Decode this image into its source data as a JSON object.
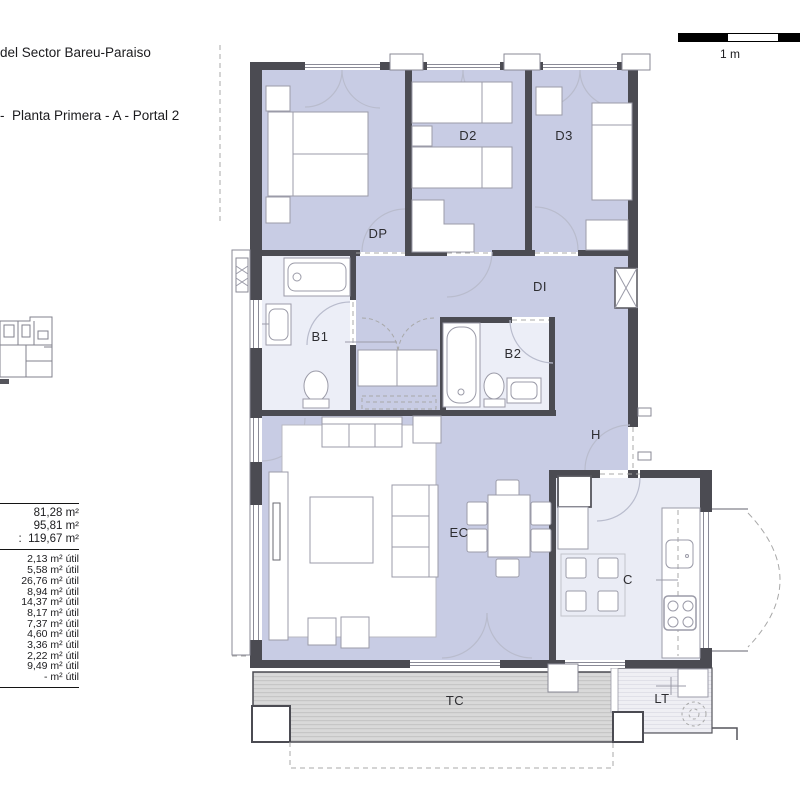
{
  "title": {
    "line1": "del Sector Bareu-Paraiso",
    "line2": "-  Planta Primera - A - Portal 2"
  },
  "scale_bar": {
    "label": "1 m"
  },
  "area_table": {
    "totals": [
      "81,28 m²",
      "95,81 m²",
      ":  119,67 m²"
    ],
    "utiles": [
      "2,13 m² útil",
      "5,58 m² útil",
      "26,76 m² útil",
      "8,94 m² útil",
      "14,37 m² útil",
      "8,17 m² útil",
      "7,37 m² útil",
      "4,60 m² útil",
      "3,36 m² útil",
      "2,22 m² útil",
      "9,49 m² útil",
      "- m² útil"
    ]
  },
  "plan": {
    "labels": {
      "dp": "DP",
      "d2": "D2",
      "d3": "D3",
      "b1": "B1",
      "b2": "B2",
      "di": "DI",
      "h": "H",
      "ec": "EC",
      "c": "C",
      "tc": "TC",
      "lt": "LT"
    }
  },
  "colors": {
    "wall": "#4b4b52",
    "room_fill": "#c8cce4",
    "wet_fill": "#eceef7",
    "kitchen_fill": "#eaecf5",
    "terrace_fill": "#d9d9d9",
    "terrace_stripe": "#c6c6c6",
    "lt_fill": "#efeff4",
    "lt_stripe": "#e0e0e8",
    "furniture_stroke": "#9b9ba8",
    "door_arc": "#b9bccd",
    "dashed_line": "#a8a8a8",
    "label_text": "#2d2d31"
  }
}
